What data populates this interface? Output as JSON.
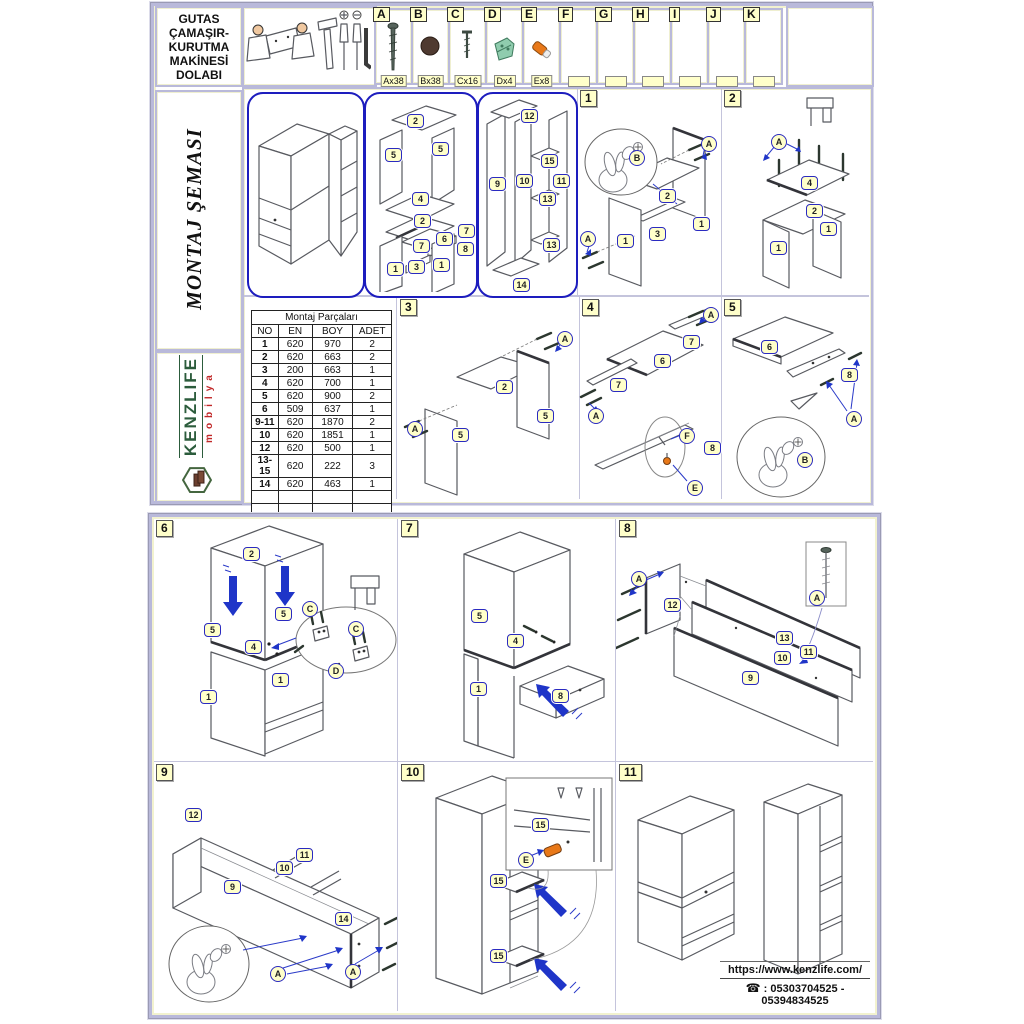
{
  "title_box": {
    "lines": [
      "GUTAS",
      "ÇAMAŞIR-",
      "KURUTMA",
      "MAKİNESİ",
      "DOLABI"
    ]
  },
  "side": {
    "schema_title": "MONTAJ ŞEMASI",
    "brand": "KENZLIFE",
    "brand_sub": "mobilya"
  },
  "hardware": {
    "items": [
      {
        "letter": "A",
        "label": "Ax38",
        "icon": "confirmat-screw"
      },
      {
        "letter": "B",
        "label": "Bx38",
        "icon": "cover-cap"
      },
      {
        "letter": "C",
        "label": "Cx16",
        "icon": "small-screw"
      },
      {
        "letter": "D",
        "label": "Dx4",
        "icon": "bracket"
      },
      {
        "letter": "E",
        "label": "Ex8",
        "icon": "dowel"
      },
      {
        "letter": "F",
        "label": "",
        "icon": ""
      },
      {
        "letter": "G",
        "label": "",
        "icon": ""
      },
      {
        "letter": "H",
        "label": "",
        "icon": ""
      },
      {
        "letter": "I",
        "label": "",
        "icon": ""
      },
      {
        "letter": "J",
        "label": "",
        "icon": ""
      },
      {
        "letter": "K",
        "label": "",
        "icon": ""
      }
    ]
  },
  "parts_table": {
    "title": "Montaj Parçaları",
    "columns": [
      "NO",
      "EN",
      "BOY",
      "ADET"
    ],
    "rows": [
      [
        "1",
        "620",
        "970",
        "2"
      ],
      [
        "2",
        "620",
        "663",
        "2"
      ],
      [
        "3",
        "200",
        "663",
        "1"
      ],
      [
        "4",
        "620",
        "700",
        "1"
      ],
      [
        "5",
        "620",
        "900",
        "2"
      ],
      [
        "6",
        "509",
        "637",
        "1"
      ],
      [
        "9-11",
        "620",
        "1870",
        "2"
      ],
      [
        "10",
        "620",
        "1851",
        "1"
      ],
      [
        "12",
        "620",
        "500",
        "1"
      ],
      [
        "13-15",
        "620",
        "222",
        "3"
      ],
      [
        "14",
        "620",
        "463",
        "1"
      ],
      [
        "",
        "",
        "",
        ""
      ],
      [
        "",
        "",
        "",
        ""
      ]
    ]
  },
  "overview": {
    "ov2_labels": [
      "2",
      "5",
      "5",
      "4",
      "2",
      "6",
      "7",
      "7",
      "8",
      "1",
      "3",
      "1"
    ],
    "ov3_labels": [
      "12",
      "15",
      "9",
      "10",
      "11",
      "13",
      "13",
      "14"
    ]
  },
  "steps": {
    "s1": {
      "num": "1",
      "labels": [
        "A",
        "B",
        "2",
        "1",
        "3",
        "1",
        "A"
      ]
    },
    "s2": {
      "num": "2",
      "labels": [
        "A",
        "4",
        "2",
        "1",
        "1"
      ]
    },
    "s3": {
      "num": "3",
      "labels": [
        "A",
        "2",
        "5",
        "5",
        "A"
      ]
    },
    "s4": {
      "num": "4",
      "labels": [
        "A",
        "7",
        "6",
        "7",
        "A",
        "F",
        "8",
        "E"
      ]
    },
    "s5": {
      "num": "5",
      "labels": [
        "6",
        "8",
        "A",
        "B"
      ]
    },
    "s6": {
      "num": "6",
      "labels": [
        "2",
        "5",
        "5",
        "4",
        "1",
        "1",
        "C",
        "C",
        "D"
      ]
    },
    "s7": {
      "num": "7",
      "labels": [
        "5",
        "4",
        "1",
        "8"
      ]
    },
    "s8": {
      "num": "8",
      "labels": [
        "A",
        "12",
        "13",
        "10",
        "11",
        "9",
        "A"
      ]
    },
    "s9": {
      "num": "9",
      "labels": [
        "12",
        "11",
        "10",
        "9",
        "14",
        "A",
        "A"
      ]
    },
    "s10": {
      "num": "10",
      "labels": [
        "15",
        "E",
        "15",
        "15"
      ]
    },
    "s11": {
      "num": "11",
      "labels": []
    }
  },
  "footer": {
    "website": "https://www.kenzlife.com/",
    "phone": ": 05303704525 - 05394834525"
  },
  "colors": {
    "accent_blue": "#1d1dbe",
    "badge_yellow": "#ffffca",
    "border_lavender": "#b9b9da",
    "brand_green": "#2c5c3c",
    "brand_red": "#c02828"
  }
}
